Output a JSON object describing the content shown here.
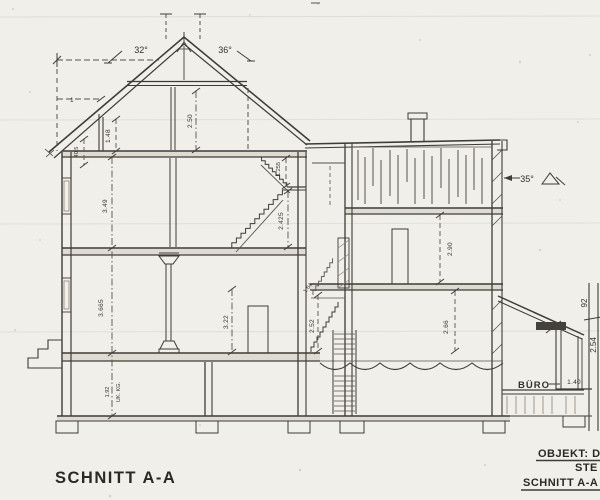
{
  "drawing": {
    "section_title": "SCHNITT A-A",
    "title_block": {
      "line1": "OBJEKT: DES",
      "line2": "STE",
      "line3": "SCHNITT A-A"
    },
    "angles": {
      "roof_left": "32°",
      "roof_right": "36°",
      "annex": "35°"
    },
    "rooms": {
      "annex": "BÜRO"
    },
    "dims": {
      "overhang": "1",
      "attic_height": "2.50",
      "knee_wall": "1.48",
      "eave_detail": "40.5",
      "og_height": "3.49",
      "eg_height": "3.665",
      "kg_height": "1.92",
      "kg_note": "UK. KG.",
      "stair_upper": "1.255",
      "stair_lower": "2.425",
      "eg_room": "3.22",
      "rear_og_height": "2.90",
      "rear_eg_height": "2.66",
      "rear_stair_height": "2.52",
      "rear_stair_label": "1.64",
      "annex_width": "1.40",
      "margin_upper": "92",
      "margin_lower": "2.54"
    }
  }
}
